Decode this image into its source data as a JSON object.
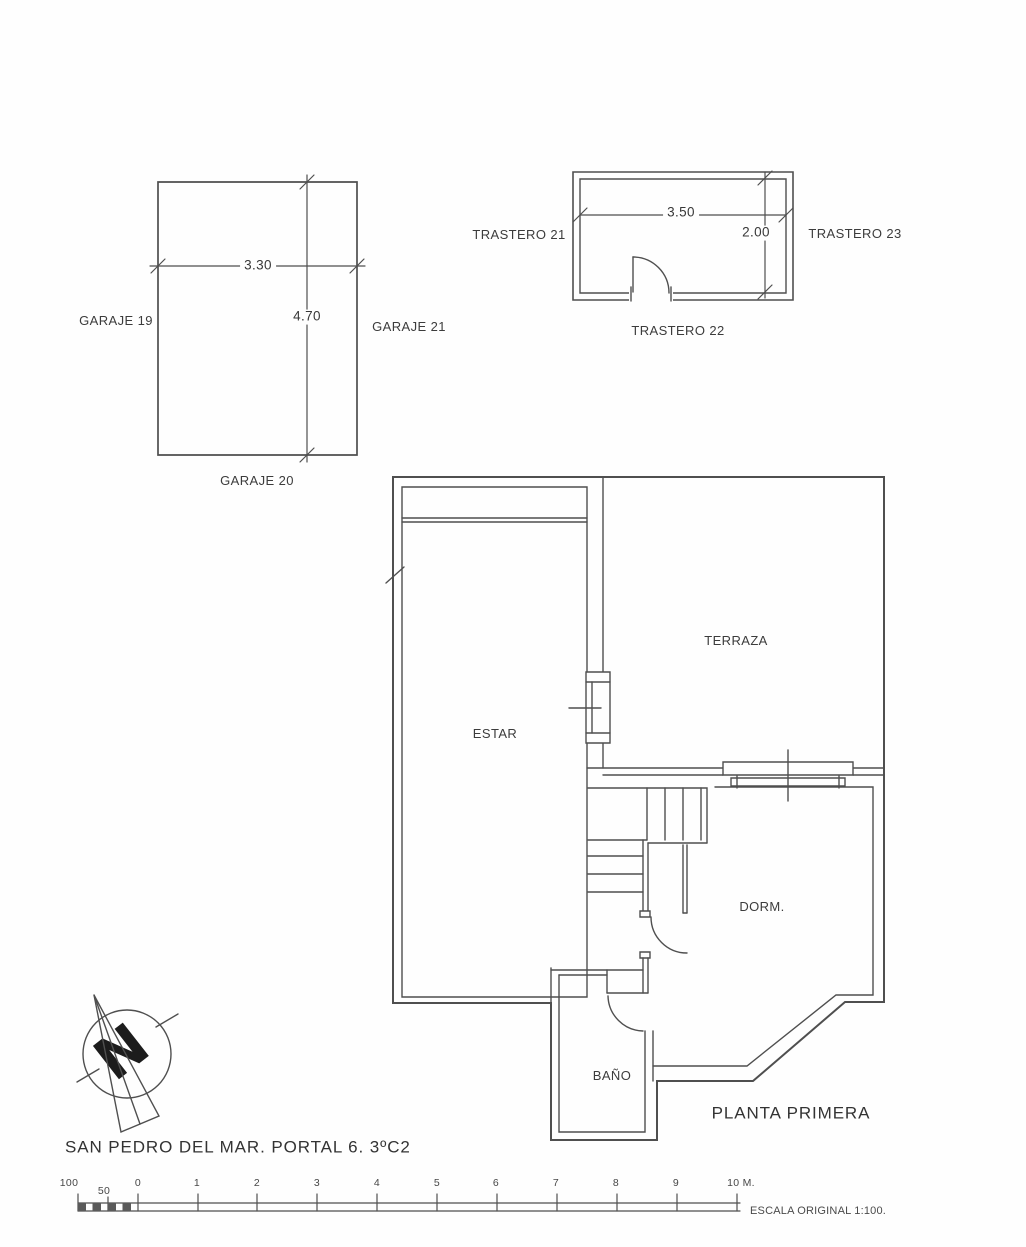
{
  "garage": {
    "left_label": "GARAJE 19",
    "right_label": "GARAJE 21",
    "bottom_label": "GARAJE 20",
    "width_dim": "3.30",
    "height_dim": "4.70"
  },
  "trastero": {
    "left_label": "TRASTERO 21",
    "right_label": "TRASTERO 23",
    "bottom_label": "TRASTERO 22",
    "width_dim": "3.50",
    "depth_dim": "2.00"
  },
  "rooms": {
    "living": "ESTAR",
    "terrace": "TERRAZA",
    "bedroom": "DORM.",
    "bath": "BAÑO"
  },
  "plan_caption": "PLANTA PRIMERA",
  "address": "SAN PEDRO DEL MAR. PORTAL 6. 3ºC2",
  "compass": {
    "north_letter": "N"
  },
  "scale_bar": {
    "tick_labels": [
      "100",
      "50",
      "0",
      "1",
      "2",
      "3",
      "4",
      "5",
      "6",
      "7",
      "8",
      "9",
      "10 M."
    ],
    "note": "ESCALA ORIGINAL 1:100."
  }
}
